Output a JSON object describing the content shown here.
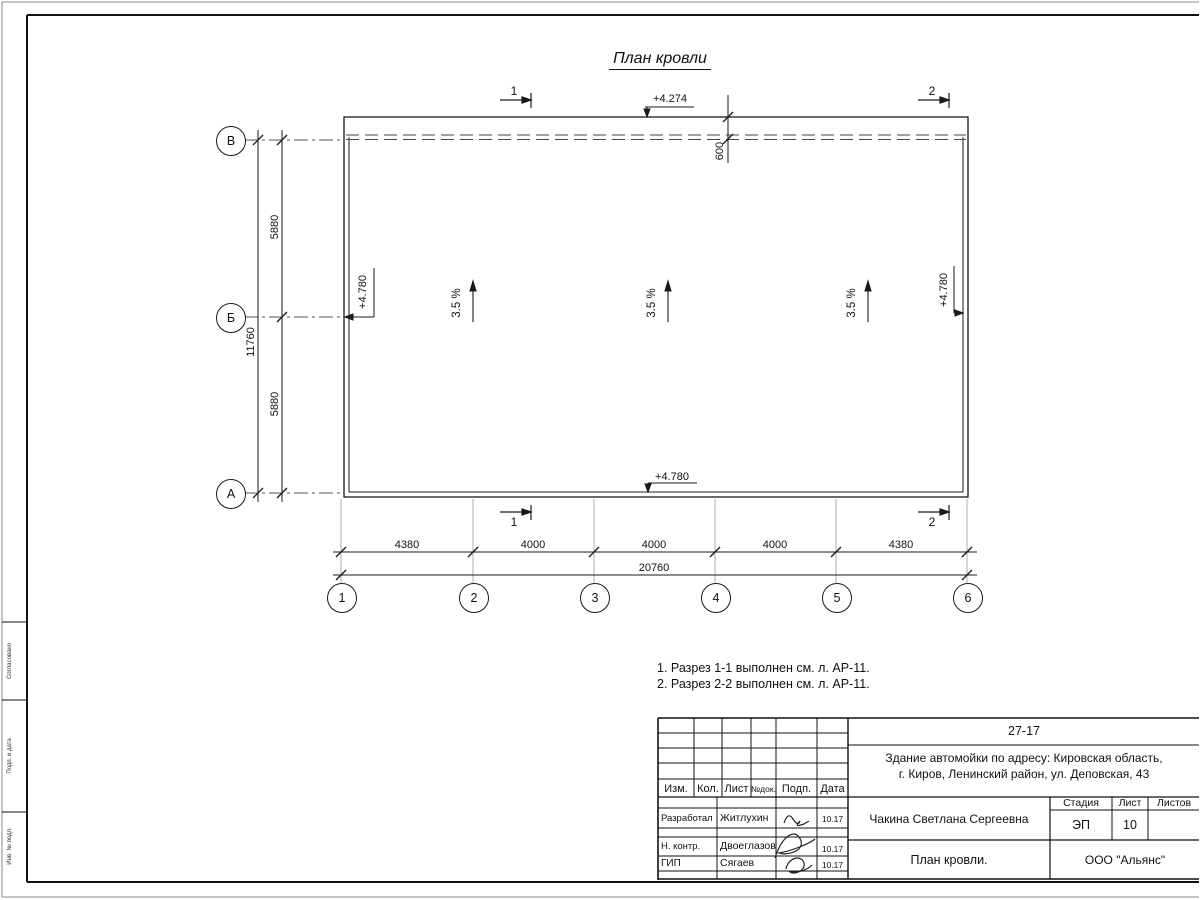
{
  "sheet": {
    "title": "План кровли"
  },
  "plan": {
    "section_marks": {
      "one": "1",
      "two": "2"
    },
    "elevation_top": "+4.274",
    "elevation_left": "+4.780",
    "elevation_right": "+4.780",
    "elevation_bottom": "+4.780",
    "parapet_offset": "600",
    "slopes": [
      "3.5 %",
      "3.5 %",
      "3.5 %"
    ],
    "row_axes": [
      "В",
      "Б",
      "А"
    ],
    "col_axes": [
      "1",
      "2",
      "3",
      "4",
      "5",
      "6"
    ],
    "dims_left": {
      "top": "5880",
      "bottom": "5880",
      "total": "11760"
    },
    "dims_bottom": {
      "segments": [
        "4380",
        "4000",
        "4000",
        "4000",
        "4380"
      ],
      "total": "20760"
    }
  },
  "notes": [
    "1. Разрез 1-1 выполнен см. л. АР-11.",
    "2. Разрез 2-2 выполнен см. л. АР-11."
  ],
  "title_block": {
    "code": "27-17",
    "project_line1": "Здание автомойки по адресу: Кировская область,",
    "project_line2": "г. Киров, Ленинский район, ул. Деповская, 43",
    "columns": [
      "Изм.",
      "Кол.",
      "Лист",
      "№док.",
      "Подп.",
      "Дата"
    ],
    "rows": [
      {
        "role": "Разработал",
        "name": "Житлухин",
        "date": "10.17"
      },
      {
        "role": "Н. контр.",
        "name": "Двоеглазов",
        "date": "10.17"
      },
      {
        "role": "ГИП",
        "name": "Сягаев",
        "date": "10.17"
      }
    ],
    "author": "Чакина Светлана Сергеевна",
    "drawing_title": "План кровли.",
    "stage_label": "Стадия",
    "sheet_label": "Лист",
    "sheets_label": "Листов",
    "stage_value": "ЭП",
    "sheet_value": "10",
    "company": "ООО \"Альянс\""
  },
  "margin": {
    "labels": [
      "Согласовано",
      "Подп. и дата",
      "Инв. № подл."
    ]
  }
}
